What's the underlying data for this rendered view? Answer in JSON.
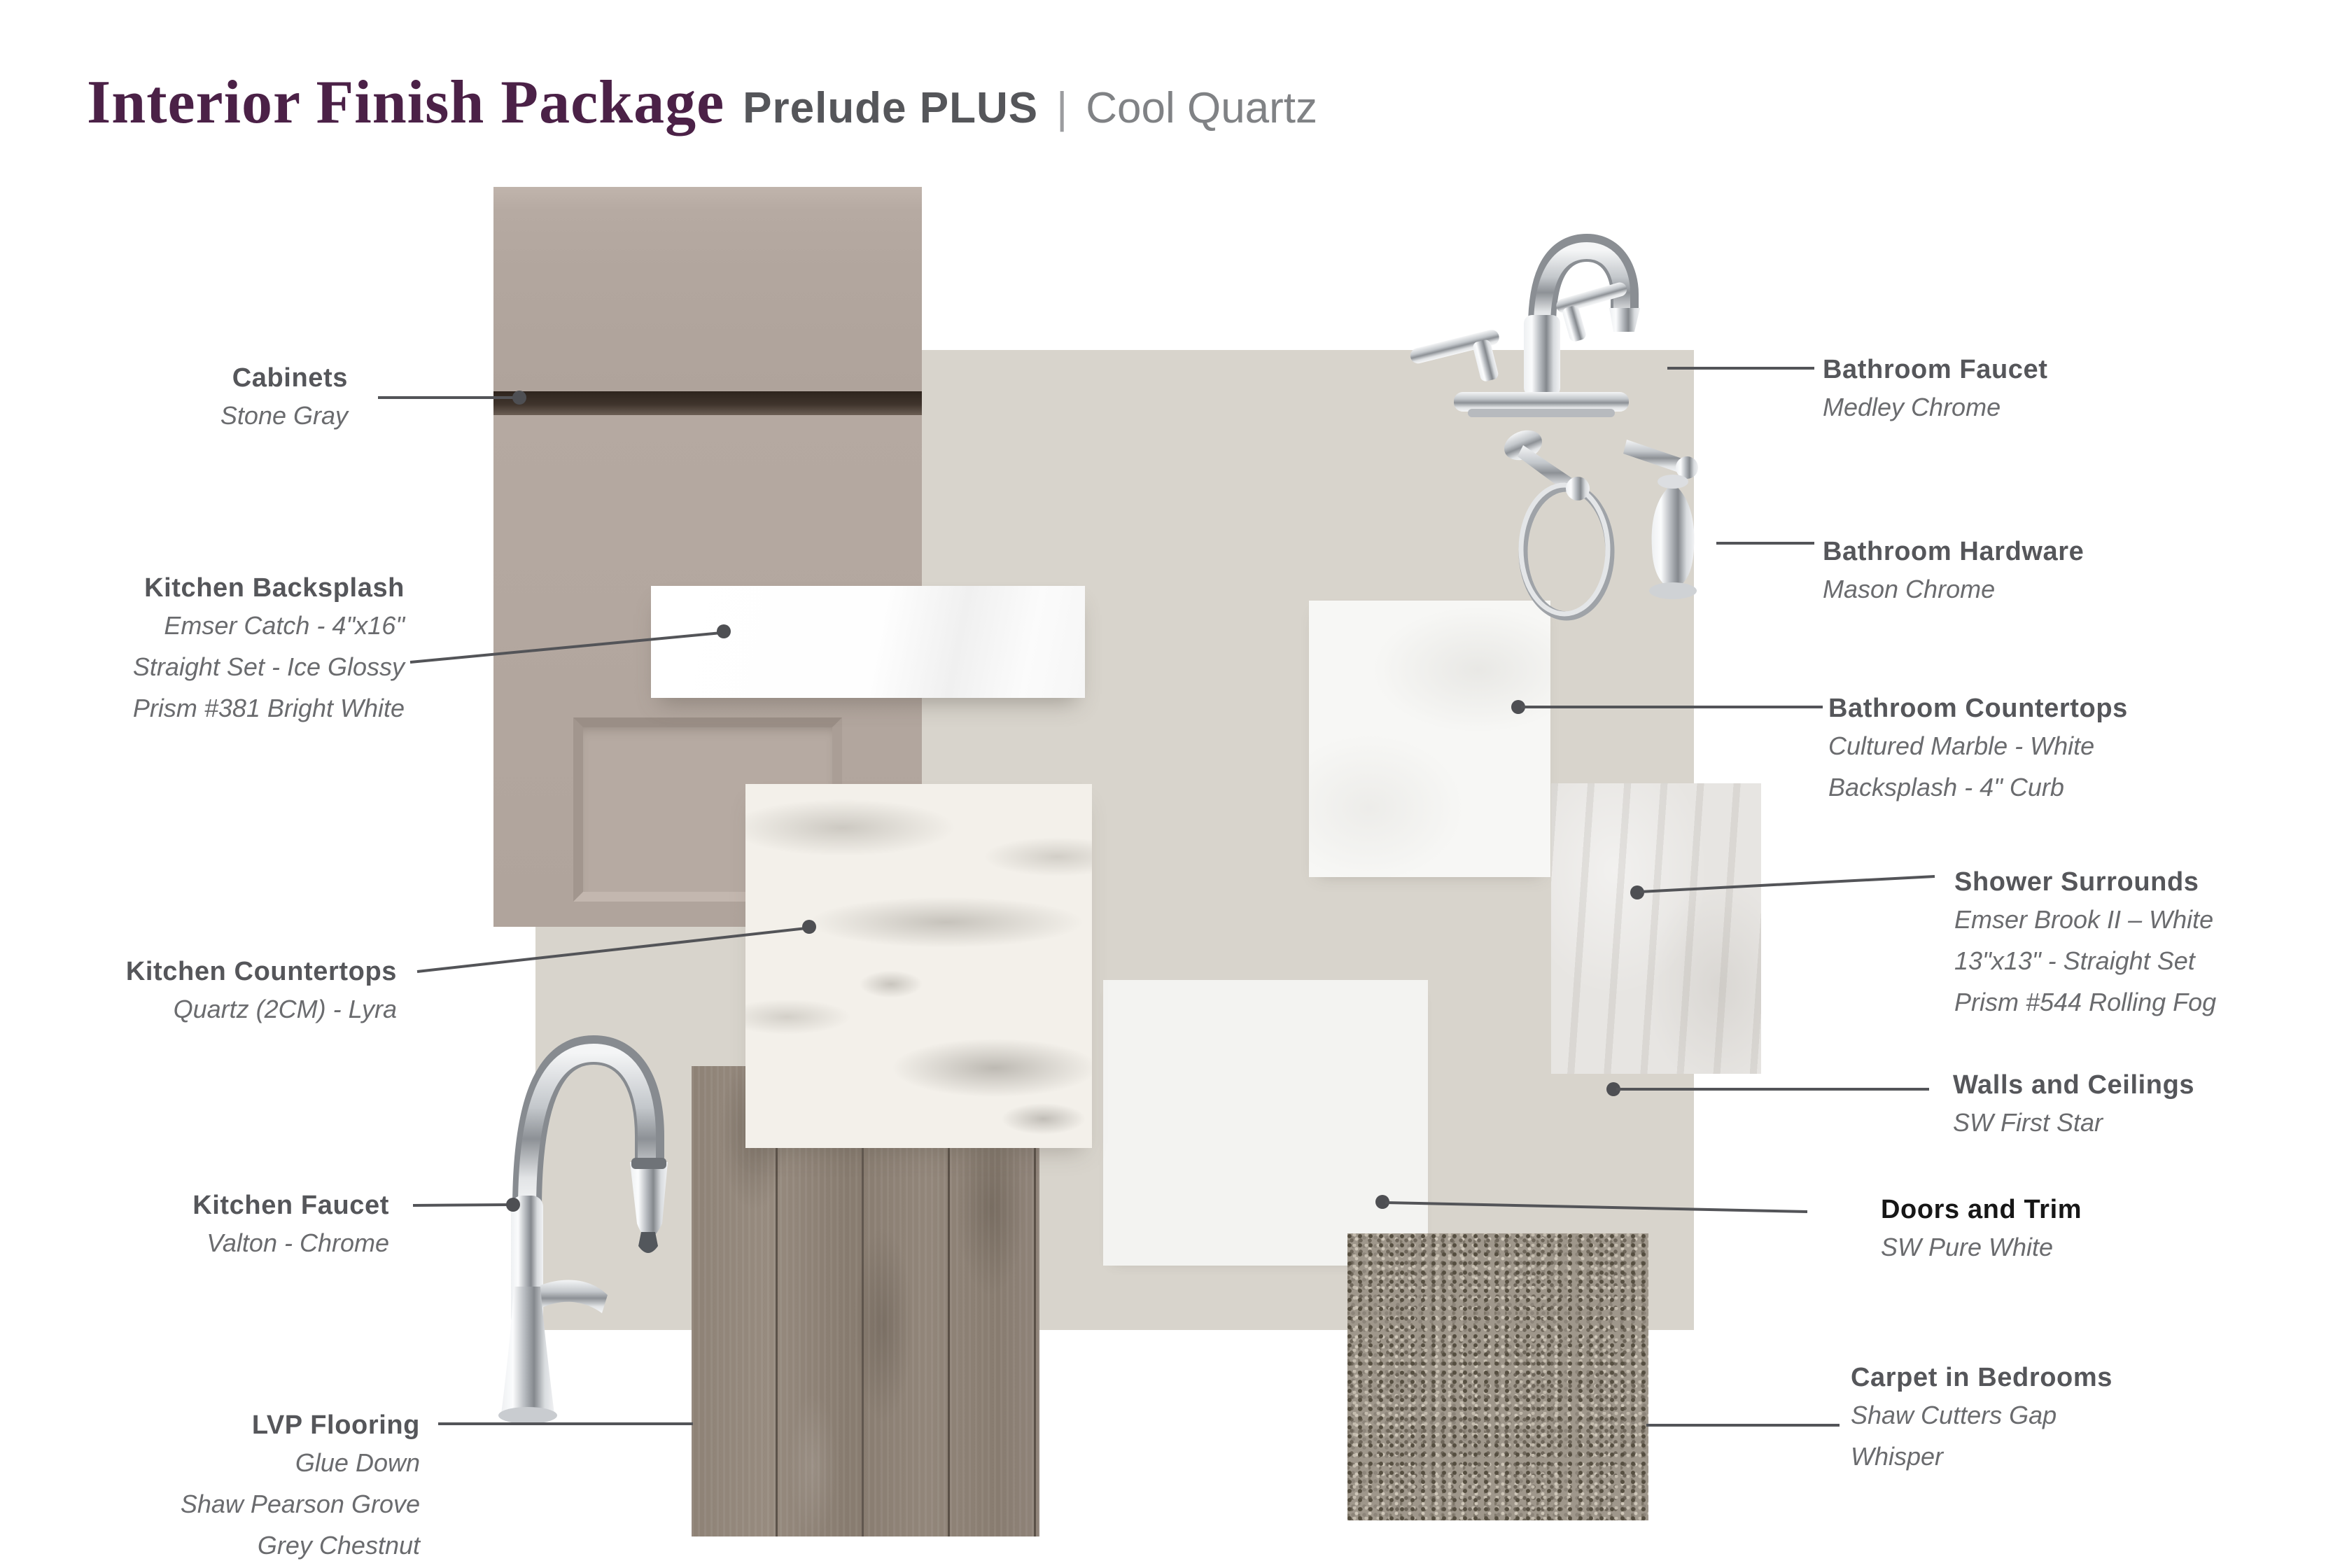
{
  "header": {
    "title": "Interior Finish Package",
    "package": "Prelude PLUS",
    "separator": "|",
    "palette": "Cool Quartz"
  },
  "labels": {
    "cabinets": {
      "title": "Cabinets",
      "lines": [
        "Stone Gray"
      ]
    },
    "kitchen_backsplash": {
      "title": "Kitchen Backsplash",
      "lines": [
        "Emser Catch - 4\"x16\"",
        "Straight Set - Ice Glossy",
        "Prism #381 Bright White"
      ]
    },
    "kitchen_countertops": {
      "title": "Kitchen Countertops",
      "lines": [
        "Quartz (2CM)  - Lyra"
      ]
    },
    "kitchen_faucet": {
      "title": "Kitchen Faucet",
      "lines": [
        "Valton - Chrome"
      ]
    },
    "lvp_flooring": {
      "title": "LVP Flooring",
      "lines": [
        "Glue Down",
        "Shaw Pearson Grove",
        "Grey Chestnut"
      ]
    },
    "bathroom_faucet": {
      "title": "Bathroom Faucet",
      "lines": [
        "Medley Chrome"
      ]
    },
    "bathroom_hardware": {
      "title": "Bathroom Hardware",
      "lines": [
        "Mason Chrome"
      ]
    },
    "bathroom_countertops": {
      "title": "Bathroom Countertops",
      "lines": [
        "Cultured Marble - White",
        "Backsplash - 4\" Curb"
      ]
    },
    "shower_surrounds": {
      "title": "Shower Surrounds",
      "lines": [
        "Emser Brook II – White",
        "13\"x13\" - Straight Set",
        "Prism #544 Rolling Fog"
      ]
    },
    "walls_ceilings": {
      "title": "Walls and Ceilings",
      "lines": [
        "SW First Star"
      ]
    },
    "doors_trim": {
      "title": "Doors and Trim",
      "lines": [
        "SW Pure White"
      ]
    },
    "carpet_bedrooms": {
      "title": "Carpet in Bedrooms",
      "lines": [
        "Shaw Cutters Gap",
        "Whisper"
      ]
    }
  },
  "colors": {
    "accent_purple": "#4b2147",
    "header_gray": "#55565a",
    "header_light_gray": "#808285",
    "label_title": "#55565a",
    "label_sub": "#6a6b6e",
    "doors_title": "#161616",
    "leader_line": "#535458",
    "wall_swatch": "#d8d4cc",
    "cabinet_swatch": "#b2a69e",
    "doors_swatch": "#f3f3f1",
    "carpet_swatch": "#9f978b",
    "lvp_swatch": "#8b7f73"
  }
}
